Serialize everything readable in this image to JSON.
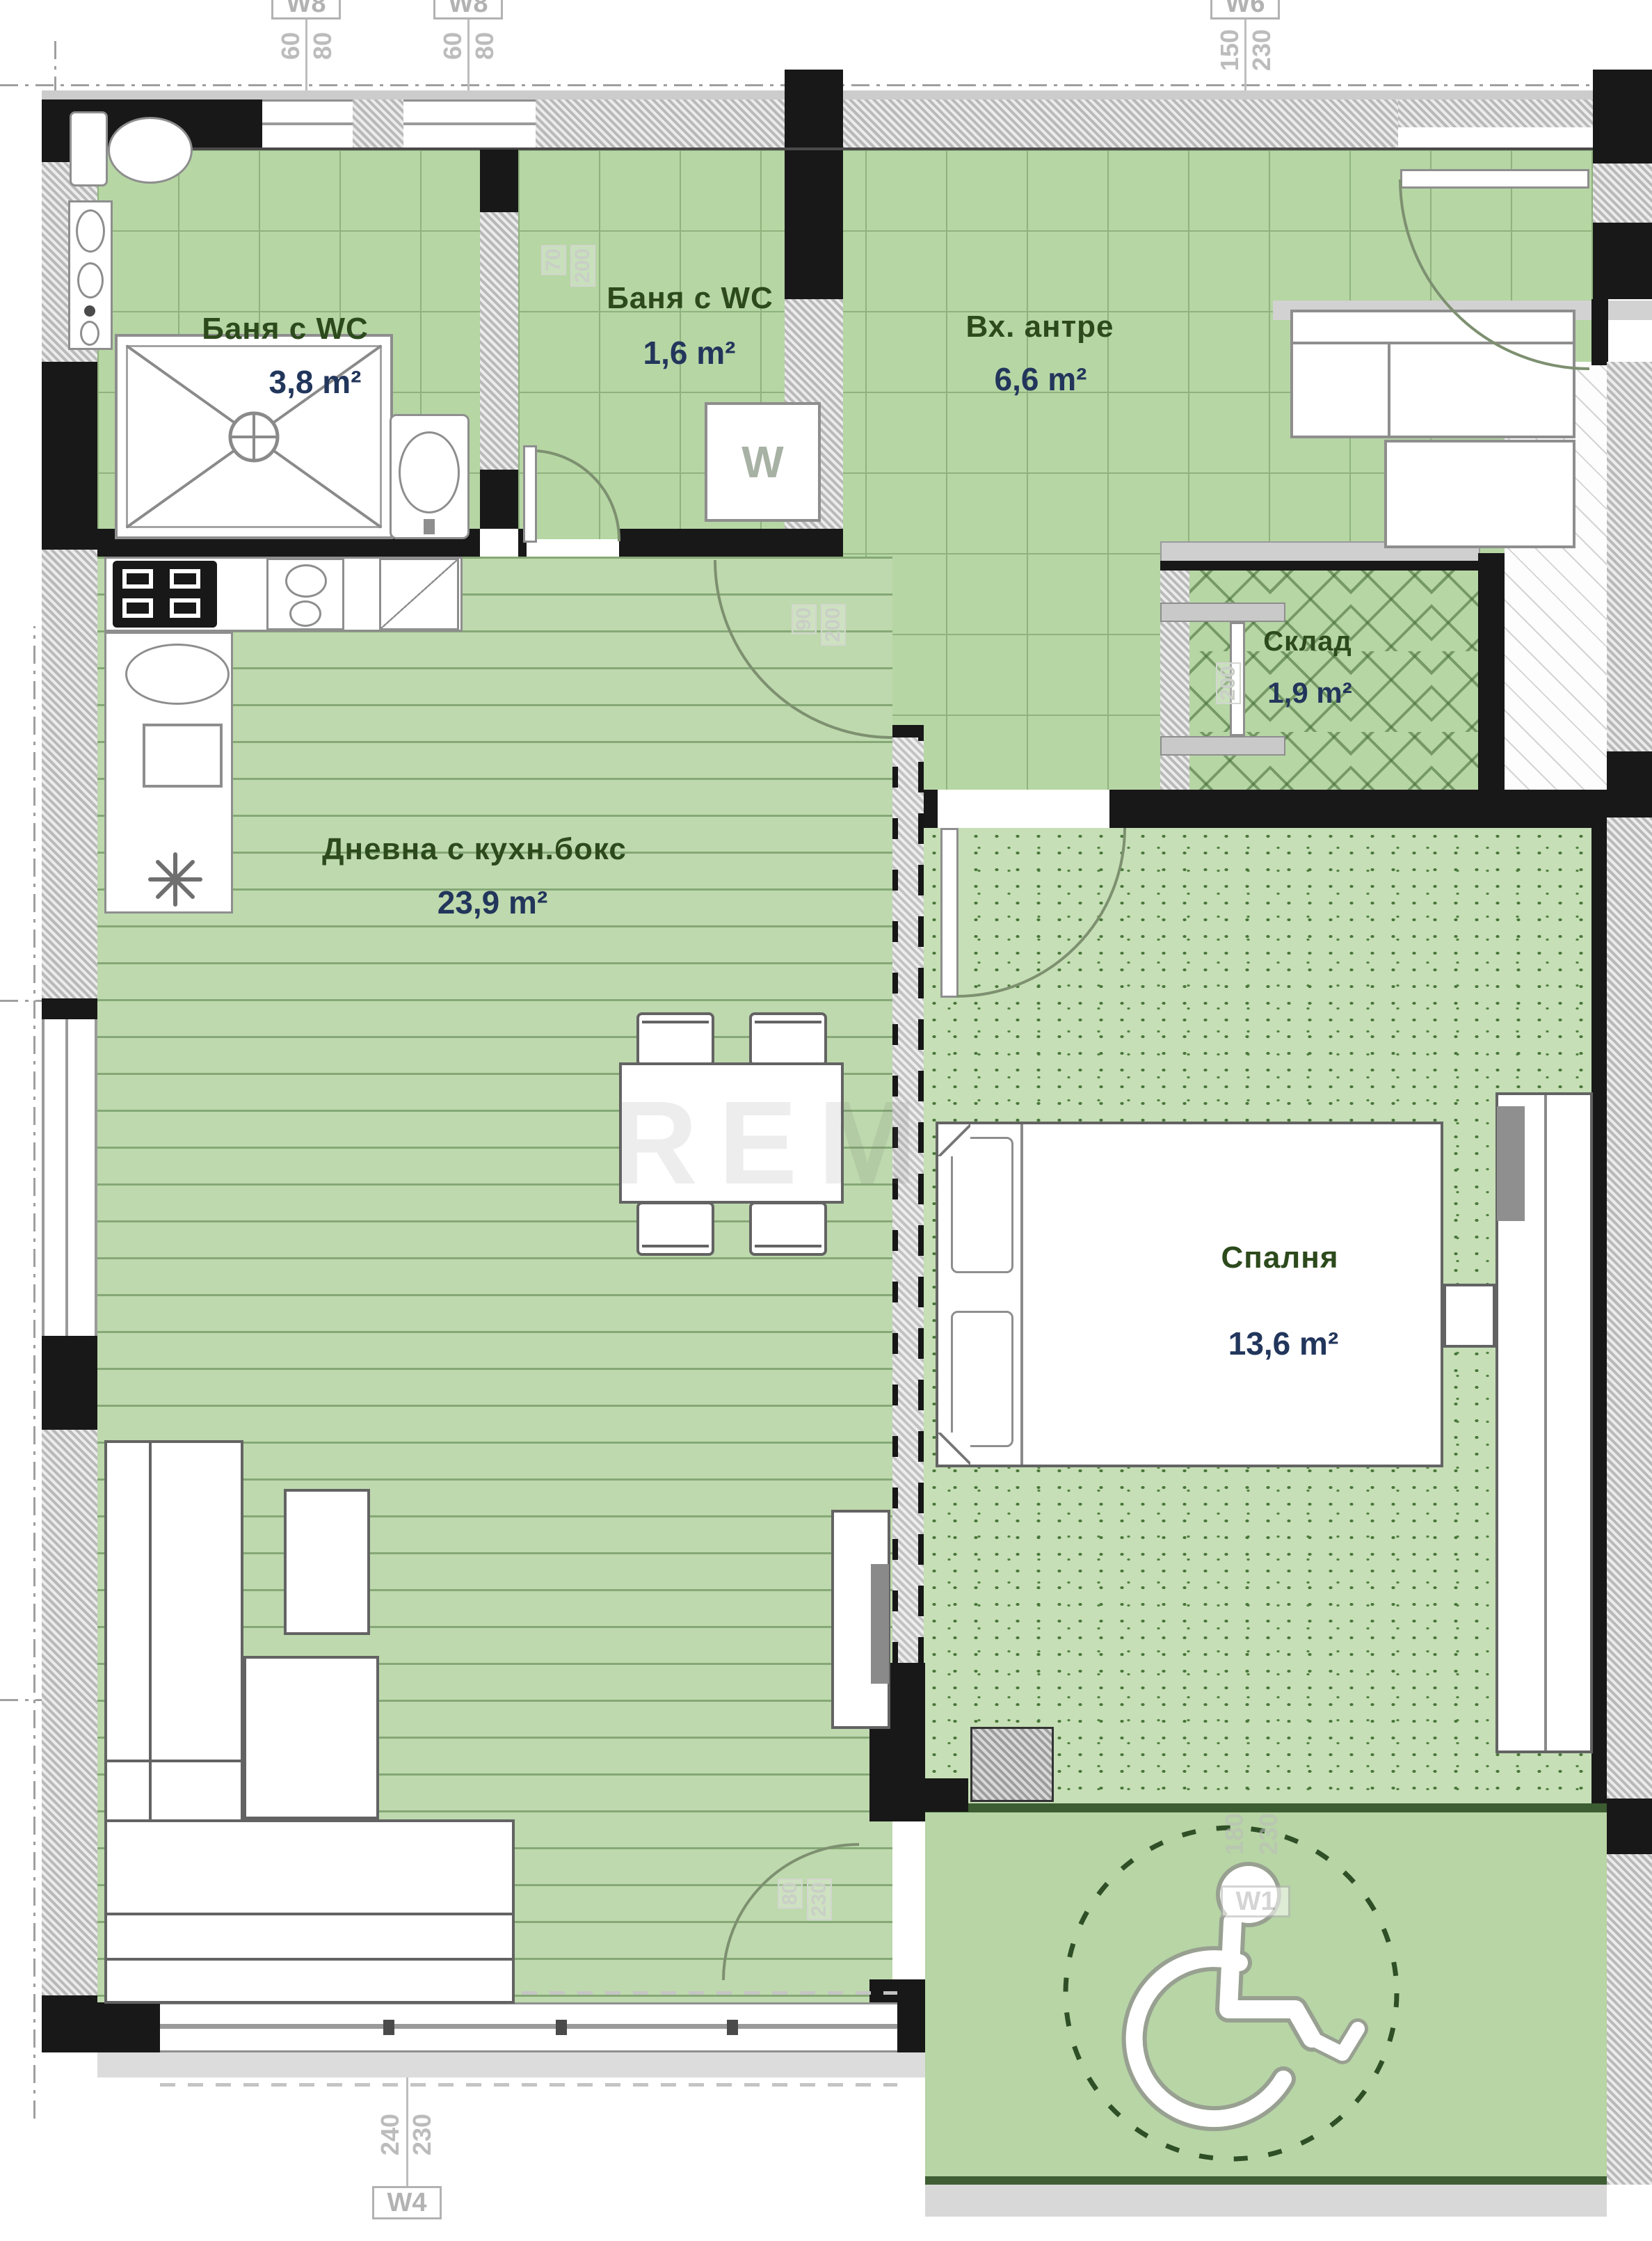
{
  "rooms": [
    {
      "name": "Баня с WC",
      "area": "3,8 m²"
    },
    {
      "name": "Баня с WC",
      "area": "1,6 m²"
    },
    {
      "name": "Вх. антре",
      "area": "6,6 m²"
    },
    {
      "name": "Склад",
      "area": "1,9 m²"
    },
    {
      "name": "Дневна с кухн.бокс",
      "area": "23,9 m²"
    },
    {
      "name": "Спалня",
      "area": "13,6 m²"
    }
  ],
  "markers": {
    "w8a": {
      "label": "W8",
      "dim1": "60",
      "dim2": "80"
    },
    "w8b": {
      "label": "W8",
      "dim1": "60",
      "dim2": "80"
    },
    "w6": {
      "label": "W6",
      "dim1": "150",
      "dim2": "230"
    },
    "w4": {
      "label": "W4",
      "dim1": "240",
      "dim2": "230"
    },
    "w1": {
      "label": "W1",
      "dim1": "180",
      "dim2": "230"
    }
  },
  "door_dims": [
    "70",
    "200",
    "90",
    "200",
    "200",
    "80",
    "230"
  ],
  "appliances": {
    "washer": "W"
  },
  "watermark": "REM",
  "colors": {
    "floor_green": "#b6d6a4",
    "plank_green": "#bed9ad",
    "speckle_green": "#c6dfb6",
    "wall_black": "#181818",
    "label_green": "#2c4a1c",
    "label_navy": "#22365c",
    "dim_gray": "#b2b2b2"
  }
}
